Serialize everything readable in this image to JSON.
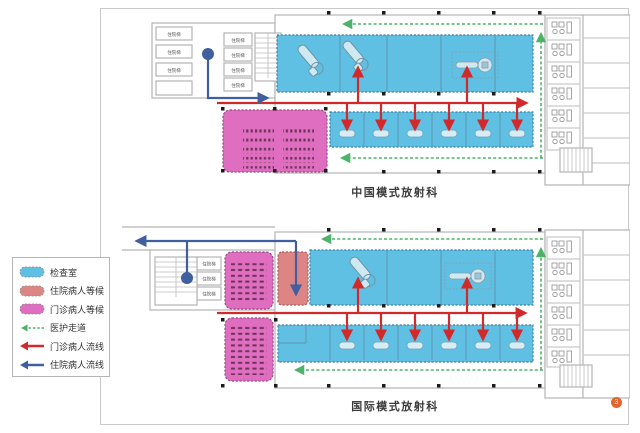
{
  "diagram": {
    "badge": "3",
    "plans": {
      "china": {
        "title": "中国模式放射科"
      },
      "international": {
        "title": "国际模式放射科"
      }
    },
    "labels": {
      "inpatient_elevator": "住院梯"
    }
  },
  "legend": {
    "items": [
      {
        "label": "检查室",
        "type": "area",
        "color": "#5fc0e4"
      },
      {
        "label": "住院病人等候",
        "type": "area",
        "color": "#dd8585"
      },
      {
        "label": "门诊病人等候",
        "type": "area",
        "color": "#e06ec0"
      },
      {
        "label": "医护走道",
        "type": "dashed-arrow",
        "color": "#4db36a"
      },
      {
        "label": "门诊病人流线",
        "type": "arrow",
        "color": "#d22a2a"
      },
      {
        "label": "住院病人流线",
        "type": "arrow",
        "color": "#3f5f9f"
      }
    ]
  },
  "colors": {
    "exam_room": "#5fc0e4",
    "inpatient_wait": "#dd8585",
    "outpatient_wait": "#e06ec0",
    "staff_corridor": "#4db36a",
    "outpatient_flow": "#d22a2a",
    "inpatient_flow": "#3f5f9f",
    "walls": "#b4b4b4",
    "badge_bg": "#e8632c"
  }
}
